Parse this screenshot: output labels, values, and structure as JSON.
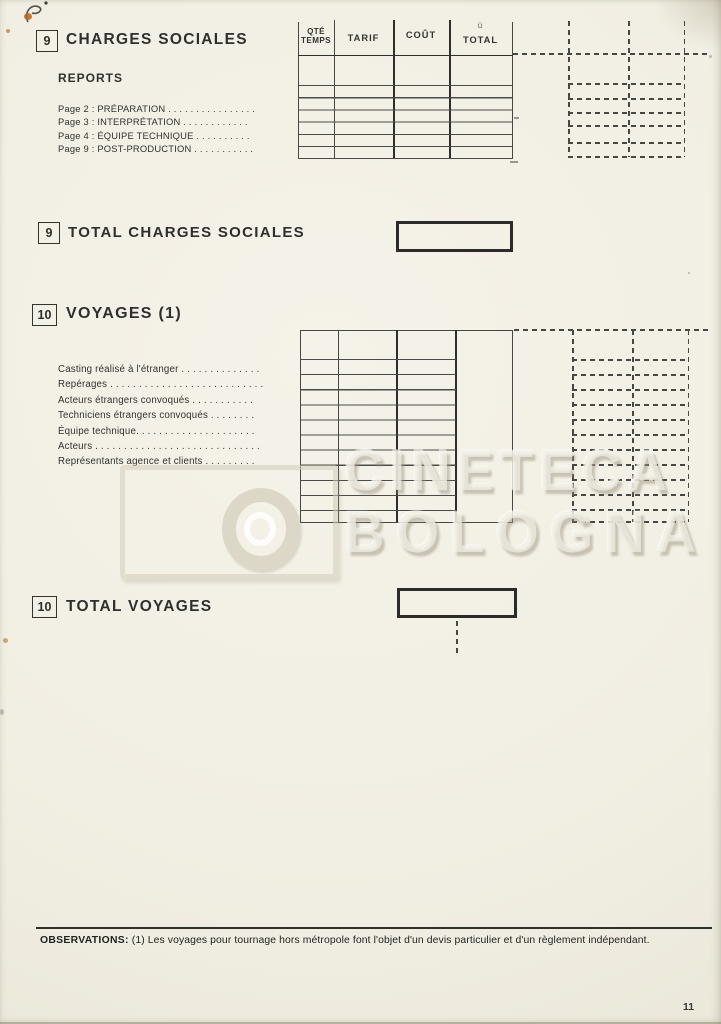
{
  "page": {
    "number": "11"
  },
  "watermark": {
    "line1": "CINETECA",
    "line2": "BOLOGNA"
  },
  "section9": {
    "number": "9",
    "title": "CHARGES SOCIALES",
    "reports_label": "REPORTS",
    "report_lines": [
      "Page 2 : PRÉPARATION . . . . . . . . . . . . . . . .",
      "Page 3 : INTERPRÉTATION . . . . . . . . . . . .",
      "Page 4 : ÉQUIPE TECHNIQUE . . . . . . . . . .",
      "Page 9 : POST-PRODUCTION . . . . . . . . . . ."
    ],
    "table_headers": {
      "col1": "QTÉ TEMPS",
      "col2": "TARIF",
      "col3": "COÛT",
      "col4": "TOTAL",
      "col4_note": "ù"
    },
    "total_number": "9",
    "total_label": "TOTAL CHARGES SOCIALES"
  },
  "section10": {
    "number": "10",
    "title": "VOYAGES (1)",
    "lines": [
      "Casting réalisé à l'étranger . . . . . . . . . . . . . .",
      "Repérages . . . . . . . . . . . . . . . . . . . . . . . . . . .",
      "Acteurs étrangers convoqués . . . . . . . . . . .",
      "Techniciens étrangers convoqués . . . . . . . .",
      "Équipe technique. . . . . . . . . . . . . . . . . . . . .",
      "Acteurs . . . . . . . . . . . . . . . . . . . . . . . . . . . . .",
      "Représentants agence et clients . . . . . . . . ."
    ],
    "total_number": "10",
    "total_label": "TOTAL VOYAGES"
  },
  "footer": {
    "observations_label": "OBSERVATIONS:",
    "observations_text": "(1) Les voyages pour tournage hors métropole font l'objet d'un devis particulier et d'un règlement indépendant."
  }
}
